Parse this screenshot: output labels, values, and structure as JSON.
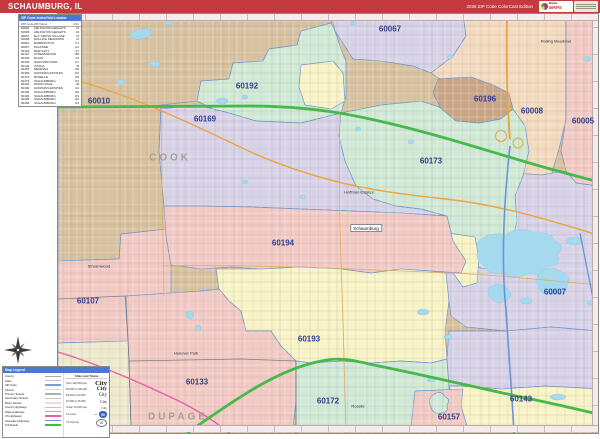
{
  "title_bar": {
    "title": "SCHAUMBURG, IL",
    "edition": "2026 ZIP Code ColorCast Edition",
    "logo": {
      "brand_top": "Market",
      "brand_main": "MAPS"
    }
  },
  "zip_index": {
    "header": "ZIP Code Index/Grid Locator",
    "columns": [
      "ZIP Code",
      "ZIP Name",
      "LOC"
    ],
    "rows": [
      {
        "code": "60004",
        "name": "ARLINGTON HEIGHTS",
        "loc": "J1"
      },
      {
        "code": "60005",
        "name": "ARLINGTON HEIGHTS",
        "loc": "J3"
      },
      {
        "code": "60007",
        "name": "ELK GROVE VILLAGE",
        "loc": "I6"
      },
      {
        "code": "60008",
        "name": "ROLLING MEADOWS",
        "loc": "I2"
      },
      {
        "code": "60010",
        "name": "BARRINGTON",
        "loc": "C1"
      },
      {
        "code": "60067",
        "name": "PALATINE",
        "loc": "G1"
      },
      {
        "code": "60103",
        "name": "BARTLETT",
        "loc": "A7"
      },
      {
        "code": "60107",
        "name": "STREAMWOOD",
        "loc": "B5"
      },
      {
        "code": "60120",
        "name": "ELGIN",
        "loc": "A4"
      },
      {
        "code": "60133",
        "name": "HANOVER PARK",
        "loc": "C7"
      },
      {
        "code": "60143",
        "name": "ITASCA",
        "loc": "I8"
      },
      {
        "code": "60157",
        "name": "MEDINAH",
        "loc": "G8"
      },
      {
        "code": "60169",
        "name": "HOFFMAN ESTATES",
        "loc": "D4"
      },
      {
        "code": "60172",
        "name": "ROSELLE",
        "loc": "F8"
      },
      {
        "code": "60173",
        "name": "SCHAUMBURG",
        "loc": "G4"
      },
      {
        "code": "60191",
        "name": "WOOD DALE",
        "loc": "J8"
      },
      {
        "code": "60192",
        "name": "HOFFMAN ESTATES",
        "loc": "C2"
      },
      {
        "code": "60193",
        "name": "SCHAUMBURG",
        "loc": "E6"
      },
      {
        "code": "60194",
        "name": "SCHAUMBURG",
        "loc": "D4"
      },
      {
        "code": "60195",
        "name": "SCHAUMBURG",
        "loc": "E3"
      },
      {
        "code": "60196",
        "name": "SCHAUMBURG",
        "loc": "G3"
      }
    ]
  },
  "map": {
    "zip_labels": [
      "60010",
      "60192",
      "60067",
      "60169",
      "60196",
      "60008",
      "60005",
      "60173",
      "60194",
      "60007",
      "60193",
      "60133",
      "60107",
      "60172",
      "60157",
      "60143"
    ],
    "county_labels": [
      {
        "name": "COOK"
      },
      {
        "name": "DUPAGE"
      }
    ],
    "city_labels": {
      "hoffman_estates": "Hoffman Estates",
      "schaumburg": "Schaumburg",
      "hanover_park": "Hanover Park",
      "streamwood": "Streamwood",
      "rolling_meadows": "Rolling Meadows",
      "roselle": "Roselle"
    }
  },
  "legend": {
    "header": "Map Legend",
    "road_rows": [
      {
        "label": "County",
        "color": "#a9a9a9"
      },
      {
        "label": "State",
        "color": "#c4c4c4"
      },
      {
        "label": "ZIP Code",
        "color": "#7d9ed8"
      },
      {
        "label": "Streets",
        "color": "#d8d8d8"
      },
      {
        "label": "Primary Streets",
        "color": "#b0b0b0"
      },
      {
        "label": "Secondary Streets",
        "color": "#c6c6c6"
      },
      {
        "label": "Minor Streets",
        "color": "#e0e0e0"
      },
      {
        "label": "County Highways",
        "color": "#e6c46a"
      },
      {
        "label": "State Highways",
        "color": "#eba53f"
      },
      {
        "label": "US Highways",
        "color": "#ea5fa4"
      },
      {
        "label": "Interstate Highways",
        "color": "#6a94d8"
      },
      {
        "label": "Toll Roads",
        "color": "#47b84c"
      }
    ],
    "cities_header": "Cities and Towns",
    "city_rows": [
      {
        "range": "Over 100,000 pop.",
        "sample": "City"
      },
      {
        "range": "50,000 to 100,000",
        "sample": "City"
      },
      {
        "range": "25,000 to 50,000",
        "sample": "City"
      },
      {
        "range": "10,000 to 25,000",
        "sample": "City"
      },
      {
        "range": "Under 10,000 pop.",
        "sample": "City"
      }
    ],
    "shields": [
      {
        "label": "Interstate",
        "number": "90"
      },
      {
        "label": "US Highway",
        "number": "20"
      }
    ]
  },
  "colors": {
    "title_bar": "#c43a40",
    "zip_label": "#313f8f",
    "water": "#a5d9ee",
    "toll_road": "#47b84c",
    "state_highway": "#eba53f",
    "us_highway": "#ea5fa4",
    "interstate": "#6a94d8",
    "region_tan": "#d7c19f",
    "region_mint": "#cfe9d6",
    "region_lavender": "#d7d2e8",
    "region_peach": "#f3d9bd",
    "region_pink": "#f3c9c4",
    "region_yellow": "#f7f3c4",
    "region_brown": "#c9a585",
    "region_cream": "#eee9cd"
  }
}
